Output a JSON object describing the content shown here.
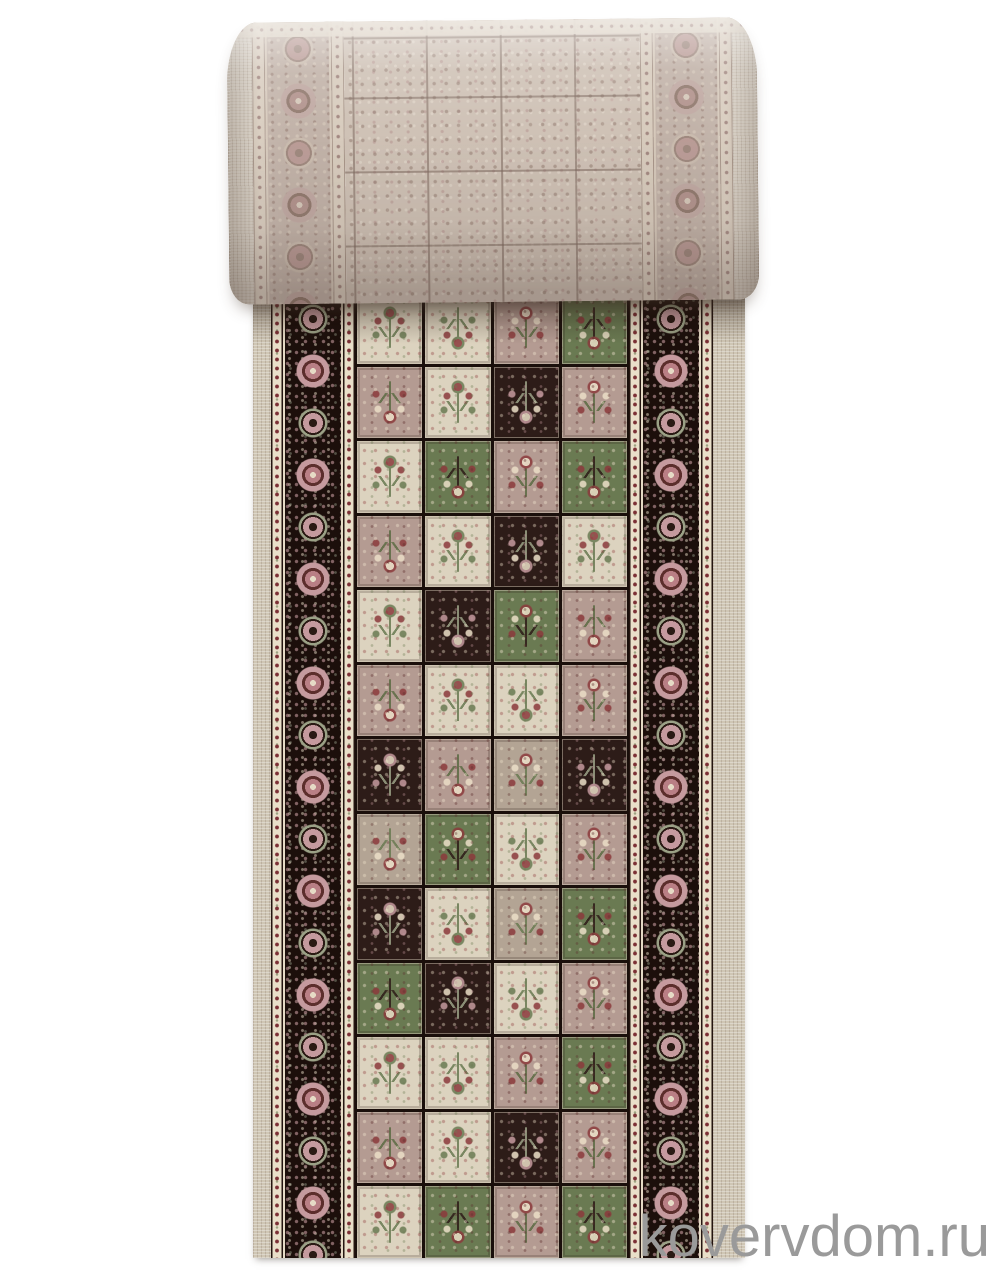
{
  "watermark": {
    "text": "kovervdom.ru",
    "color": "#9a9a9a"
  },
  "photo": {
    "background": "#ffffff",
    "subject": "rolled-carpet-runner-panel-design",
    "roll": {
      "base": "#cfc2b6",
      "selvedge": "#d5ccbf",
      "border_bg": "#c2b3a9"
    },
    "runner": {
      "selvedge": "#cfc6b4",
      "guard_bg": "#e9dfc9",
      "guard_dot": "#7c3136",
      "border_bg": "#1c0f0b",
      "border_rose": "#c59a9e",
      "border_cream": "#e6dbc6",
      "grid_line": "#1a0f0b",
      "tile_colors": {
        "cream": "#dcd3bf",
        "rose": "#b49b92",
        "taupe": "#b3a494",
        "dark": "#2d1c18",
        "green": "#6a7a52"
      },
      "tile_grid": [
        [
          "cream",
          "cream",
          "rose",
          "green"
        ],
        [
          "rose",
          "cream",
          "dark",
          "rose"
        ],
        [
          "cream",
          "green",
          "rose",
          "green"
        ],
        [
          "rose",
          "cream",
          "dark",
          "cream"
        ],
        [
          "cream",
          "dark",
          "green",
          "rose"
        ],
        [
          "rose",
          "cream",
          "cream",
          "rose"
        ],
        [
          "dark",
          "rose",
          "taupe",
          "dark"
        ],
        [
          "taupe",
          "green",
          "cream",
          "rose"
        ],
        [
          "dark",
          "cream",
          "taupe",
          "green"
        ],
        [
          "green",
          "dark",
          "cream",
          "rose"
        ],
        [
          "cream",
          "cream",
          "rose",
          "green"
        ],
        [
          "rose",
          "cream",
          "dark",
          "rose"
        ],
        [
          "cream",
          "green",
          "rose",
          "green"
        ]
      ]
    }
  }
}
